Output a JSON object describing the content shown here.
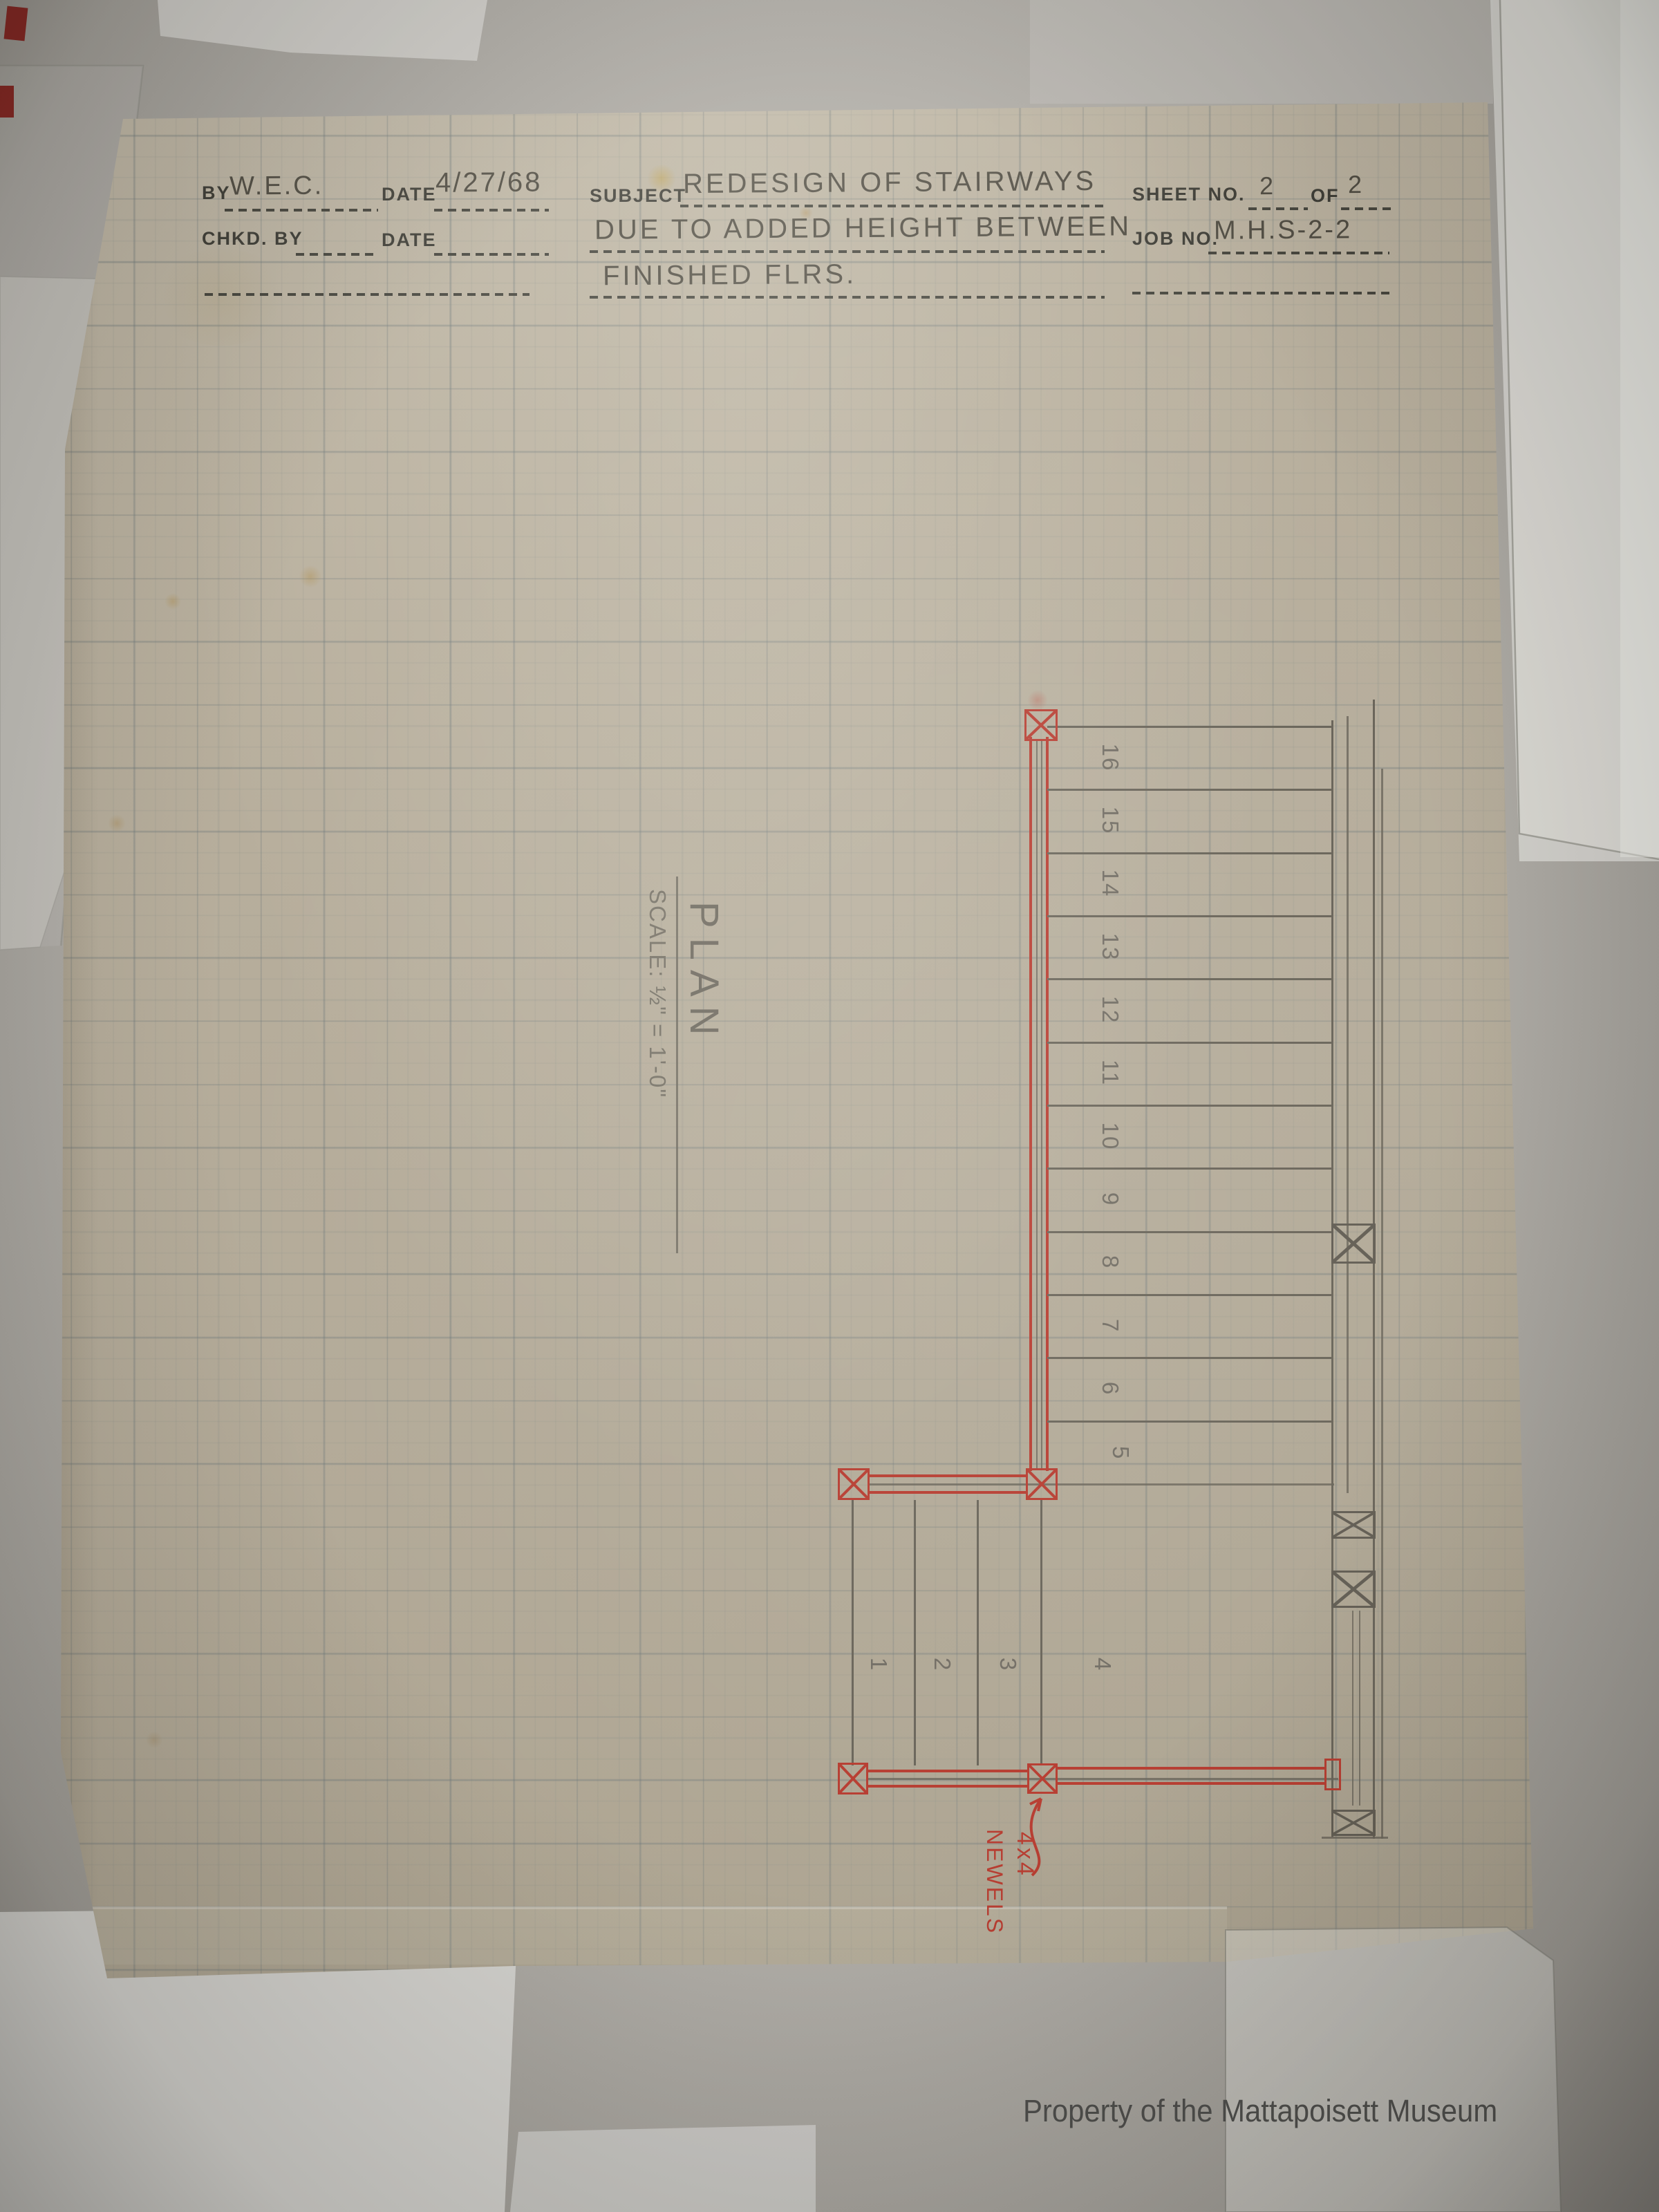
{
  "title_block": {
    "by_label": "BY",
    "by_value": "W.E.C.",
    "date_label": "DATE",
    "date_value": "4/27/68",
    "chkd_by_label": "CHKD. BY",
    "chkd_date_label": "DATE",
    "subject_label": "SUBJECT",
    "subject_lines": [
      "REDESIGN OF STAIRWAYS",
      "DUE TO ADDED HEIGHT BETWEEN",
      "FINISHED FLRS."
    ],
    "sheet_no_label": "SHEET NO.",
    "sheet_no_value": "2",
    "of_label": "OF",
    "of_value": "2",
    "job_no_label": "JOB NO.",
    "job_no_value": "M.H.S-2-2"
  },
  "plan": {
    "title": "PLAN",
    "scale_note": "SCALE: ½\" = 1'-0\"",
    "upper_tread_numbers": [
      "16",
      "15",
      "14",
      "13",
      "12",
      "11",
      "10",
      "9",
      "8",
      "7",
      "6",
      "5"
    ],
    "lower_tread_numbers": [
      "1",
      "2",
      "3",
      "4"
    ],
    "newel_note_line1": "4x4",
    "newel_note_line2": "NEWELS"
  },
  "watermark": "Property of the Mattapoisett Museum",
  "colors": {
    "red_pencil": "#b5382c",
    "graphite": "#5f5a50",
    "paper": "#b3aa98"
  }
}
